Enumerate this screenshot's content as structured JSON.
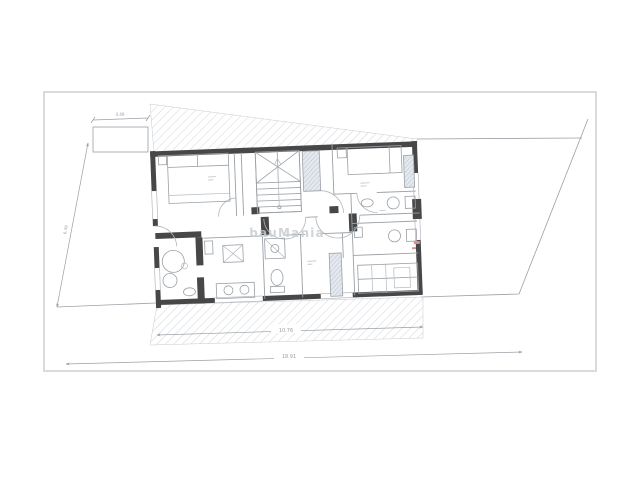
{
  "drawing": {
    "watermark": "bauMania",
    "dimensions": {
      "garage_width": "4.49",
      "site_left_length": "6.39",
      "building_width": "10.76",
      "site_total_width": "18.91"
    },
    "colors": {
      "background": "#ffffff",
      "frame": "#d9dcdf",
      "wall": "#474747",
      "line": "#9aa0a6",
      "thin": "#b3b8be",
      "hatch": "#c6cbd1",
      "shaft_fill": "#e4e9ef",
      "shaft_hatch": "#a9b3c0",
      "dim_text": "#9aa0a6",
      "watermark": "#c9cdd2",
      "accent_red": "#dc8f8f"
    }
  }
}
